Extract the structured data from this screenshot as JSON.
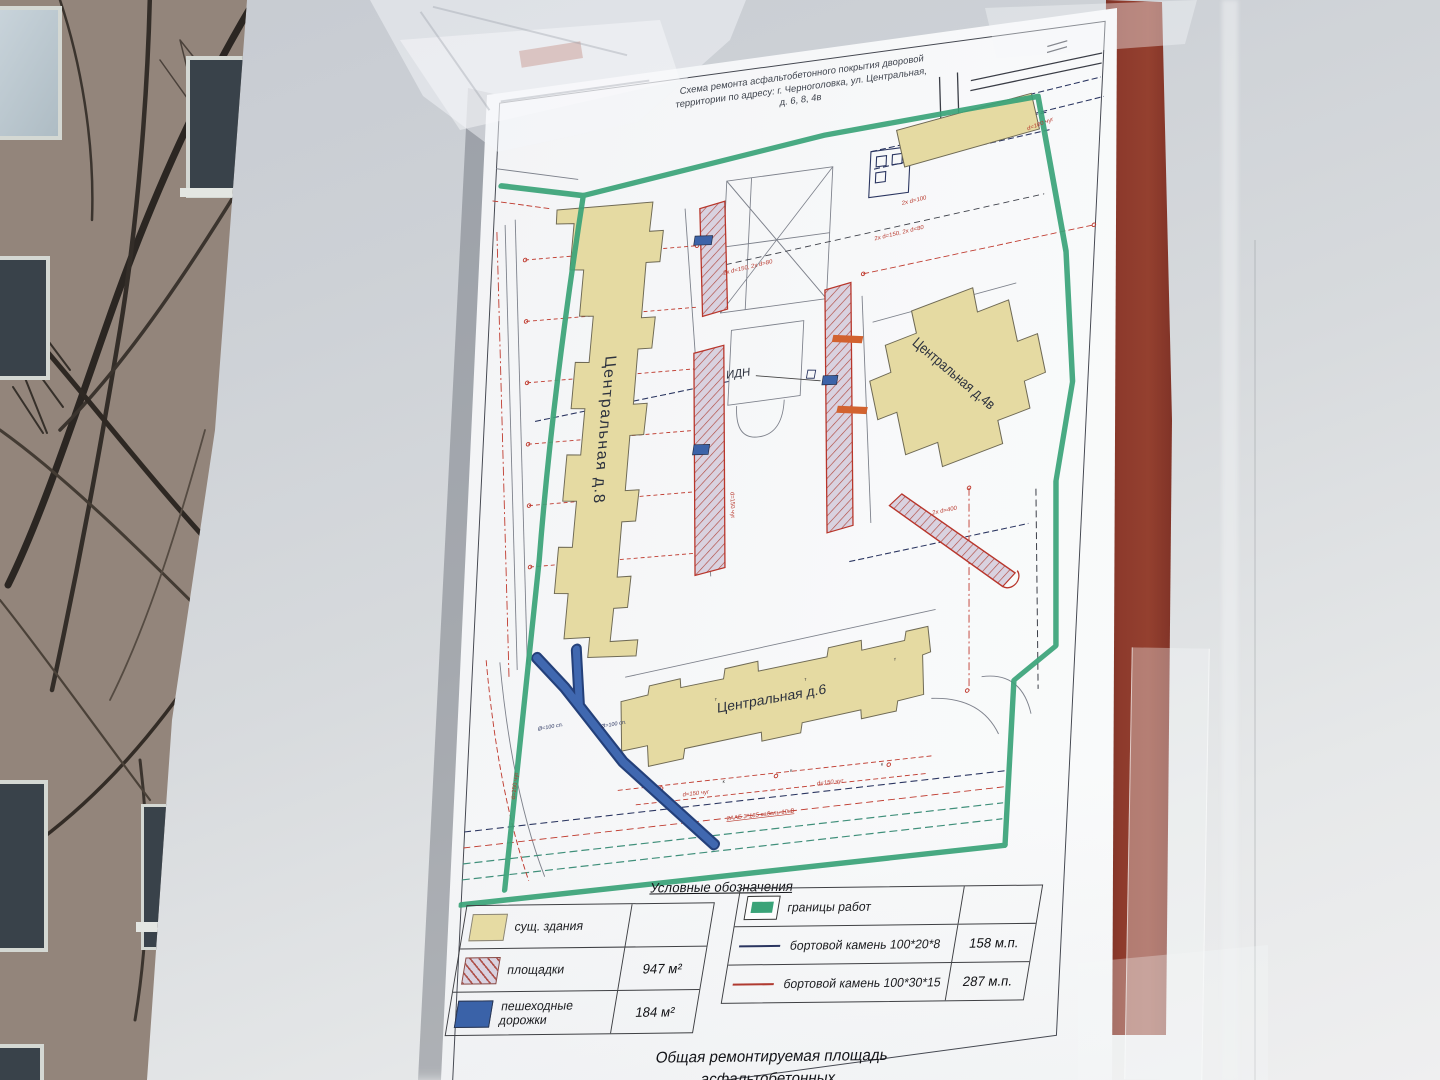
{
  "title": {
    "line1": "Схема ремонта асфальтобетонного покрытия дворовой",
    "line2": "территории по адресу: г. Черноголовка, ул. Центральная,",
    "line3": "д. 6, 8, 4в"
  },
  "map": {
    "buildings": {
      "d8": "Центральная д.8",
      "d4v": "Центральная д.4в",
      "d6": "Центральная д.6"
    },
    "idn": "ИДН",
    "annotations": {
      "dim_150_80": "2х d=150, 2х d=80",
      "dim_100": "2х d=100",
      "dim_400": "2х d=400",
      "d150": "d=150 чуг",
      "d250": "d=250 чуг",
      "d100": "d=100 чуг",
      "cable": "2ААБ 3*185 кабель 10кВ",
      "dia100": "Ø=100 сп.",
      "mark_t": "т",
      "mark_k": "к"
    }
  },
  "legend": {
    "header": "Условные обозначения",
    "areas": [
      {
        "label": "сущ. здания",
        "value": ""
      },
      {
        "label": "площадки",
        "value": "947 м²"
      },
      {
        "label": "пешеходные дорожки",
        "value": "184 м²"
      }
    ],
    "lines": [
      {
        "label": "границы работ",
        "value": ""
      },
      {
        "label": "бортовой камень 100*20*8",
        "value": "158 м.п."
      },
      {
        "label": "бортовой камень 100*30*15",
        "value": "287 м.п."
      }
    ],
    "total_line1": "Общая ремонтируемая  площадь асфальтобетонных",
    "total_line2": "покрытий составляет 1131 м²"
  },
  "colors": {
    "boundary_green": "#3aa378",
    "building_fill": "#e5daa2",
    "path_blue": "#3c63a8",
    "curb_navy": "#2a3560",
    "curb_red": "#b03a30",
    "board_maroon": "#87352a"
  }
}
